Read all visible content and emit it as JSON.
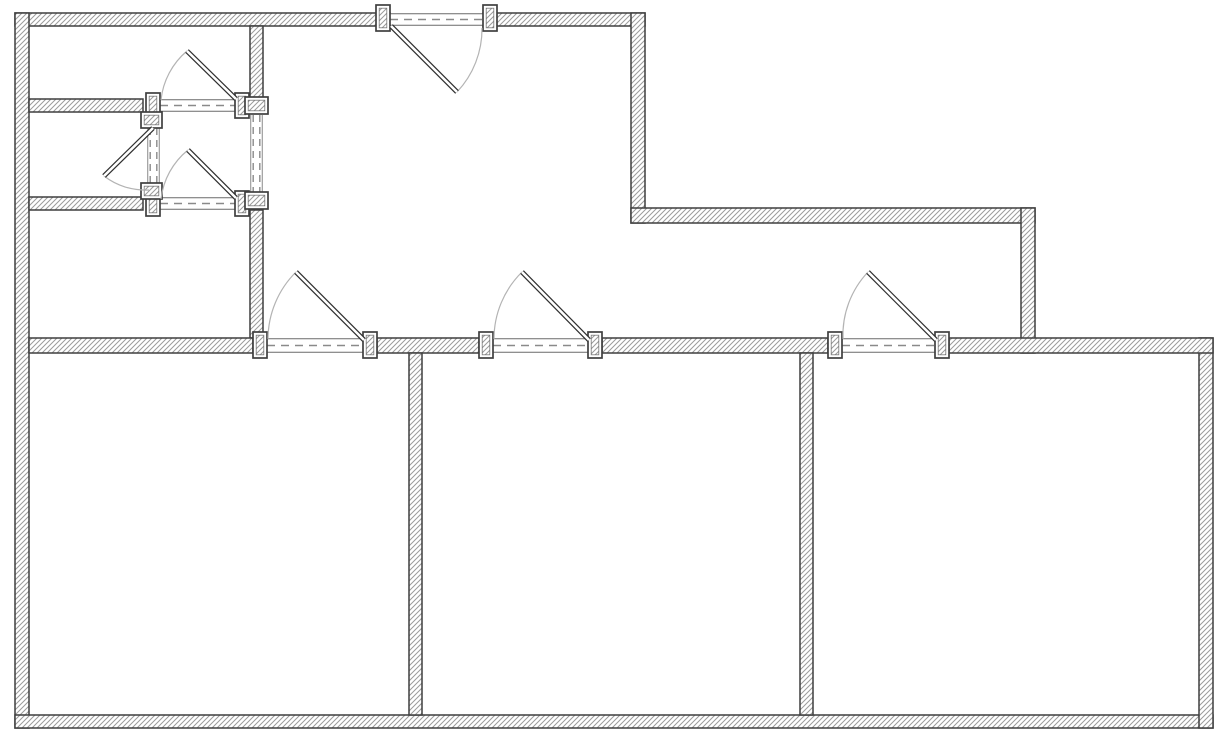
{
  "document": {
    "kind": "floor-plan-drawing",
    "visible_text": []
  },
  "canvas": {
    "width": 1225,
    "height": 740,
    "background": "#ffffff"
  },
  "style": {
    "wall_outline": "#3f3f3f",
    "wall_outline_width": 1.5,
    "hatch_line": "#9b9b9b",
    "hatch_bg": "#ffffff",
    "hatch_pitch": 5,
    "opening_edge": "#6a6a6a",
    "dash_color": "#8a8a8a",
    "dash_pattern": "8 6",
    "arc_color": "#b3b3b3",
    "leaf_outline": "#2f2f2f",
    "leaf_fill": "#ffffff",
    "jamb_fill": "#ffffff",
    "jamb_outline": "#3f3f3f"
  },
  "chart_data": {
    "type": "table",
    "title": "",
    "note": "Floor plan geometry in screenshot pixel coordinates",
    "walls": [
      {
        "id": "top-wall-west",
        "x": 15,
        "y": 13,
        "w": 375,
        "h": 13
      },
      {
        "id": "top-wall-east",
        "x": 483,
        "y": 13,
        "w": 162,
        "h": 13
      },
      {
        "id": "left-wall",
        "x": 15,
        "y": 13,
        "w": 14,
        "h": 715
      },
      {
        "id": "bottom-wall",
        "x": 15,
        "y": 715,
        "w": 1198,
        "h": 13
      },
      {
        "id": "right-wall",
        "x": 1199,
        "y": 338,
        "w": 14,
        "h": 390
      },
      {
        "id": "hall-east-wall",
        "x": 631,
        "y": 13,
        "w": 14,
        "h": 210
      },
      {
        "id": "step-north-wall",
        "x": 631,
        "y": 208,
        "w": 404,
        "h": 15
      },
      {
        "id": "step-east-wall",
        "x": 1021,
        "y": 208,
        "w": 14,
        "h": 145
      },
      {
        "id": "closet-north-wall",
        "x": 29,
        "y": 99,
        "w": 114,
        "h": 13
      },
      {
        "id": "closet-south-wall",
        "x": 29,
        "y": 197,
        "w": 114,
        "h": 13
      },
      {
        "id": "left-divider-upper",
        "x": 250,
        "y": 26,
        "w": 13,
        "h": 73
      },
      {
        "id": "left-divider-lower",
        "x": 250,
        "y": 210,
        "w": 13,
        "h": 128
      },
      {
        "id": "south-corridor-wall-a",
        "x": 29,
        "y": 338,
        "w": 224,
        "h": 15
      },
      {
        "id": "south-corridor-wall-b",
        "x": 377,
        "y": 338,
        "w": 102,
        "h": 15
      },
      {
        "id": "south-corridor-wall-c",
        "x": 602,
        "y": 338,
        "w": 226,
        "h": 15
      },
      {
        "id": "south-corridor-wall-d",
        "x": 949,
        "y": 338,
        "w": 264,
        "h": 15
      },
      {
        "id": "room-divider-west",
        "x": 409,
        "y": 353,
        "w": 13,
        "h": 362
      },
      {
        "id": "room-divider-east",
        "x": 800,
        "y": 353,
        "w": 13,
        "h": 362
      }
    ],
    "openings": [
      {
        "id": "entry-opening",
        "orient": "h",
        "x": 390,
        "y": 13,
        "len": 93,
        "thick": 13,
        "style": "edges-dash"
      },
      {
        "id": "room1-opening",
        "orient": "h",
        "x": 267,
        "y": 338,
        "len": 96,
        "thick": 15,
        "style": "edges-dash"
      },
      {
        "id": "room2-opening",
        "orient": "h",
        "x": 493,
        "y": 338,
        "len": 95,
        "thick": 15,
        "style": "edges-dash"
      },
      {
        "id": "room3-opening",
        "orient": "h",
        "x": 842,
        "y": 338,
        "len": 93,
        "thick": 15,
        "style": "edges-dash"
      },
      {
        "id": "vestibule-north-opening",
        "orient": "h",
        "x": 160,
        "y": 99,
        "len": 75,
        "thick": 13,
        "style": "edges-dash"
      },
      {
        "id": "vestibule-south-opening",
        "orient": "h",
        "x": 160,
        "y": 197,
        "len": 75,
        "thick": 13,
        "style": "edges-dash"
      },
      {
        "id": "vestibule-west-opening",
        "orient": "v",
        "x": 147,
        "y": 128,
        "len": 55,
        "thick": 13,
        "style": "double-dash"
      },
      {
        "id": "hall-passage-opening",
        "orient": "v",
        "x": 250,
        "y": 115,
        "len": 77,
        "thick": 13,
        "style": "double-dash"
      }
    ],
    "jambs": [
      {
        "id": "entry-jamb-left",
        "x": 376,
        "y": 5,
        "w": 14,
        "h": 26
      },
      {
        "id": "entry-jamb-right",
        "x": 483,
        "y": 5,
        "w": 14,
        "h": 26
      },
      {
        "id": "room1-jamb-left",
        "x": 253,
        "y": 332,
        "w": 14,
        "h": 26
      },
      {
        "id": "room1-jamb-right",
        "x": 363,
        "y": 332,
        "w": 14,
        "h": 26
      },
      {
        "id": "room2-jamb-left",
        "x": 479,
        "y": 332,
        "w": 14,
        "h": 26
      },
      {
        "id": "room2-jamb-right",
        "x": 588,
        "y": 332,
        "w": 14,
        "h": 26
      },
      {
        "id": "room3-jamb-left",
        "x": 828,
        "y": 332,
        "w": 14,
        "h": 26
      },
      {
        "id": "room3-jamb-right",
        "x": 935,
        "y": 332,
        "w": 14,
        "h": 26
      },
      {
        "id": "vestibule-north-jamb-left",
        "x": 146,
        "y": 93,
        "w": 14,
        "h": 25
      },
      {
        "id": "vestibule-north-jamb-right",
        "x": 235,
        "y": 93,
        "w": 14,
        "h": 25
      },
      {
        "id": "vestibule-south-jamb-left",
        "x": 146,
        "y": 191,
        "w": 14,
        "h": 25
      },
      {
        "id": "vestibule-south-jamb-right",
        "x": 235,
        "y": 191,
        "w": 14,
        "h": 25
      },
      {
        "id": "vestibule-west-jamb-top",
        "x": 141,
        "y": 112,
        "w": 21,
        "h": 16
      },
      {
        "id": "vestibule-west-jamb-bottom",
        "x": 141,
        "y": 183,
        "w": 21,
        "h": 16
      },
      {
        "id": "hall-passage-jamb-top",
        "x": 245,
        "y": 97,
        "w": 23,
        "h": 17
      },
      {
        "id": "hall-passage-jamb-bottom",
        "x": 245,
        "y": 192,
        "w": 23,
        "h": 17
      }
    ],
    "doors": [
      {
        "id": "entry-door",
        "leaf": {
          "x1": 391,
          "y1": 26,
          "x2": 457,
          "y2": 92
        },
        "arc": {
          "x1": 482,
          "y1": 28,
          "x2": 457,
          "y2": 92,
          "r": 92,
          "sweep": 1
        }
      },
      {
        "id": "room1-door",
        "leaf": {
          "x1": 364,
          "y1": 340,
          "x2": 296,
          "y2": 272
        },
        "arc": {
          "x1": 268,
          "y1": 339,
          "x2": 296,
          "y2": 272,
          "r": 95,
          "sweep": 1
        }
      },
      {
        "id": "room2-door",
        "leaf": {
          "x1": 589,
          "y1": 340,
          "x2": 522,
          "y2": 272
        },
        "arc": {
          "x1": 494,
          "y1": 339,
          "x2": 522,
          "y2": 272,
          "r": 94,
          "sweep": 1
        }
      },
      {
        "id": "room3-door",
        "leaf": {
          "x1": 936,
          "y1": 340,
          "x2": 868,
          "y2": 272
        },
        "arc": {
          "x1": 843,
          "y1": 339,
          "x2": 868,
          "y2": 272,
          "r": 92,
          "sweep": 1
        }
      },
      {
        "id": "vestibule-north-door",
        "leaf": {
          "x1": 236,
          "y1": 99,
          "x2": 187,
          "y2": 51
        },
        "arc": {
          "x1": 161,
          "y1": 100,
          "x2": 187,
          "y2": 51,
          "r": 74,
          "sweep": 1
        }
      },
      {
        "id": "vestibule-south-door",
        "leaf": {
          "x1": 236,
          "y1": 198,
          "x2": 188,
          "y2": 150
        },
        "arc": {
          "x1": 161,
          "y1": 199,
          "x2": 188,
          "y2": 150,
          "r": 74,
          "sweep": 1
        }
      },
      {
        "id": "vestibule-west-door",
        "leaf": {
          "x1": 153,
          "y1": 128,
          "x2": 104,
          "y2": 176
        },
        "arc": {
          "x1": 104,
          "y1": 176,
          "x2": 149,
          "y2": 190,
          "r": 68,
          "sweep": 0
        }
      }
    ]
  }
}
